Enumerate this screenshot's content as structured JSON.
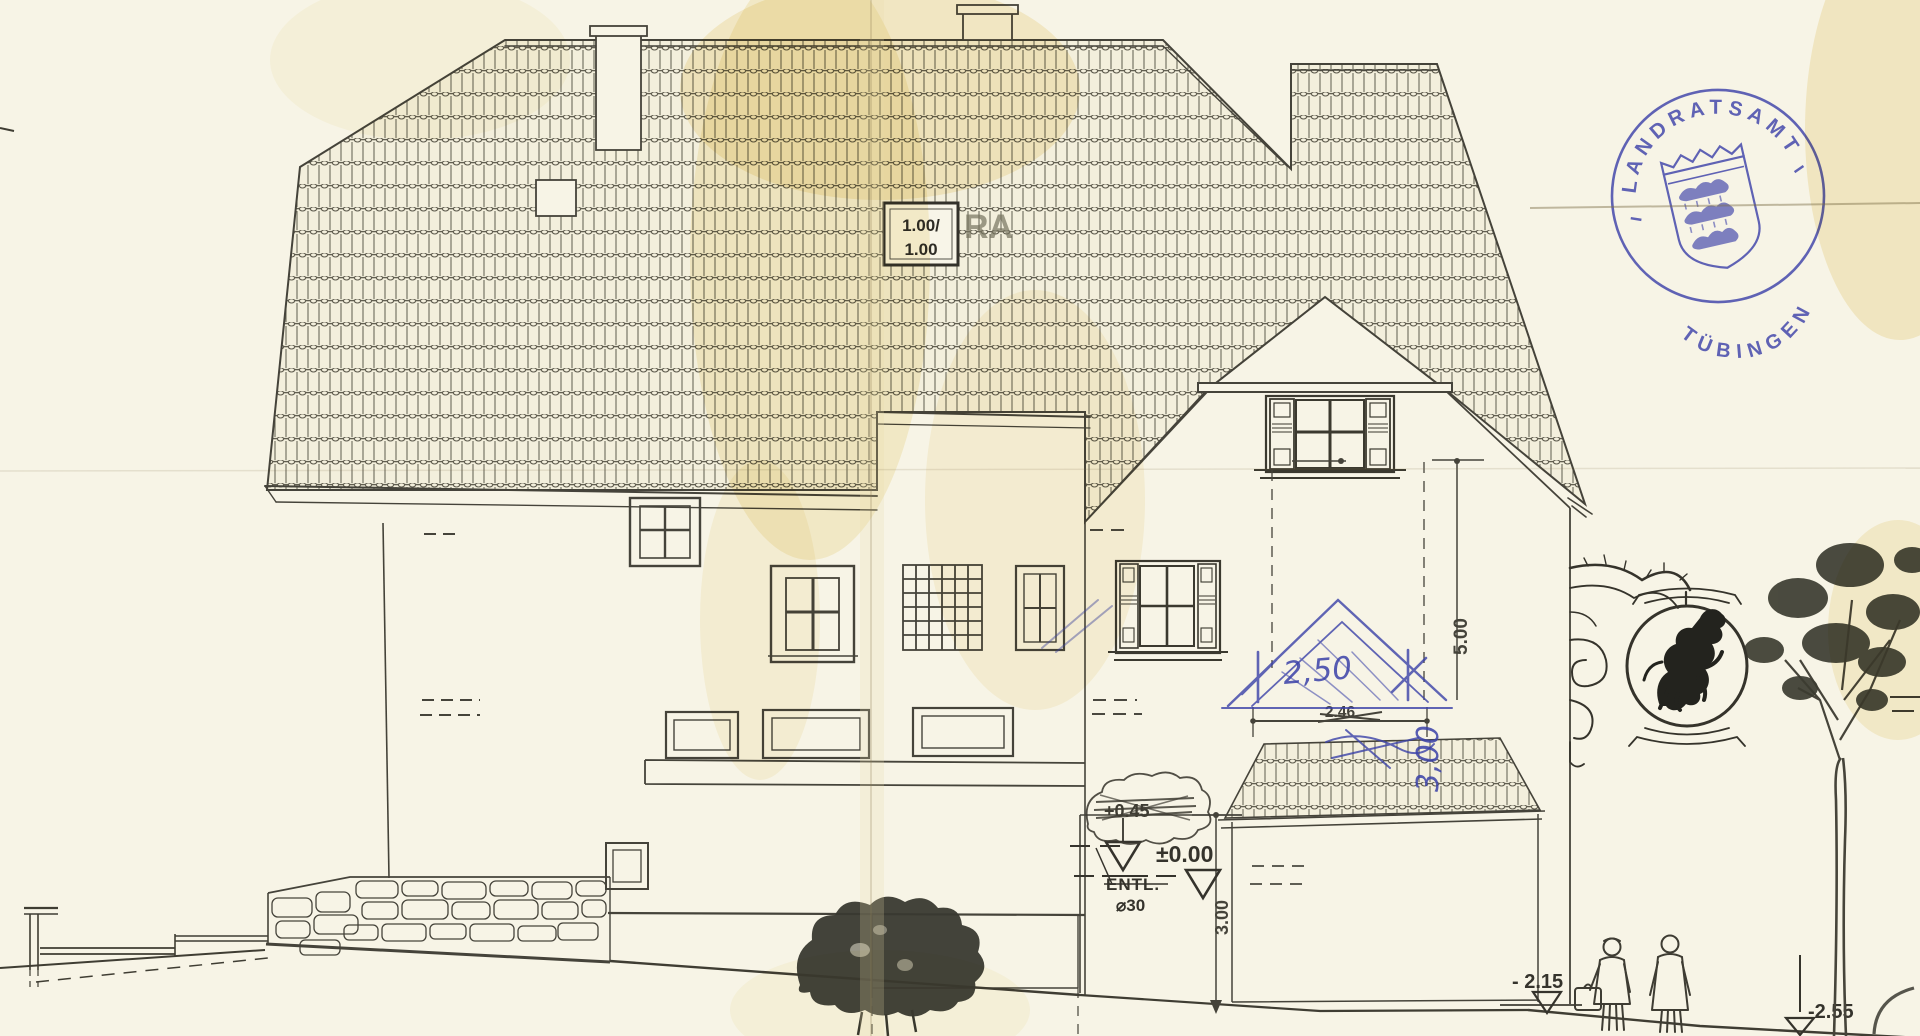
{
  "drawing": {
    "roof_box": {
      "line1": "1.00/",
      "line2": "1.00",
      "stencil": "RA"
    },
    "dimensions": {
      "width_hand_blue": "2,50",
      "width_printed": "2.46",
      "height_gable": "5.00",
      "height_basement": "3.00",
      "height_hand_blue": "3,00"
    },
    "levels": {
      "zero": "±0.00",
      "scribbled_out": "+0.45",
      "minus_215": "- 2.15",
      "minus_255": "-2.55"
    },
    "drain": {
      "label": "ENTL.",
      "size": "⌀30"
    },
    "stamp": {
      "arc_top": "LANDRATSAMT",
      "arc_bottom": "TÜBINGEN"
    },
    "colors": {
      "paper": "#f7f4e6",
      "ink": "#4a4840",
      "pencil_blue": "#3a41a8",
      "stamp_blue": "#4549ac"
    }
  }
}
